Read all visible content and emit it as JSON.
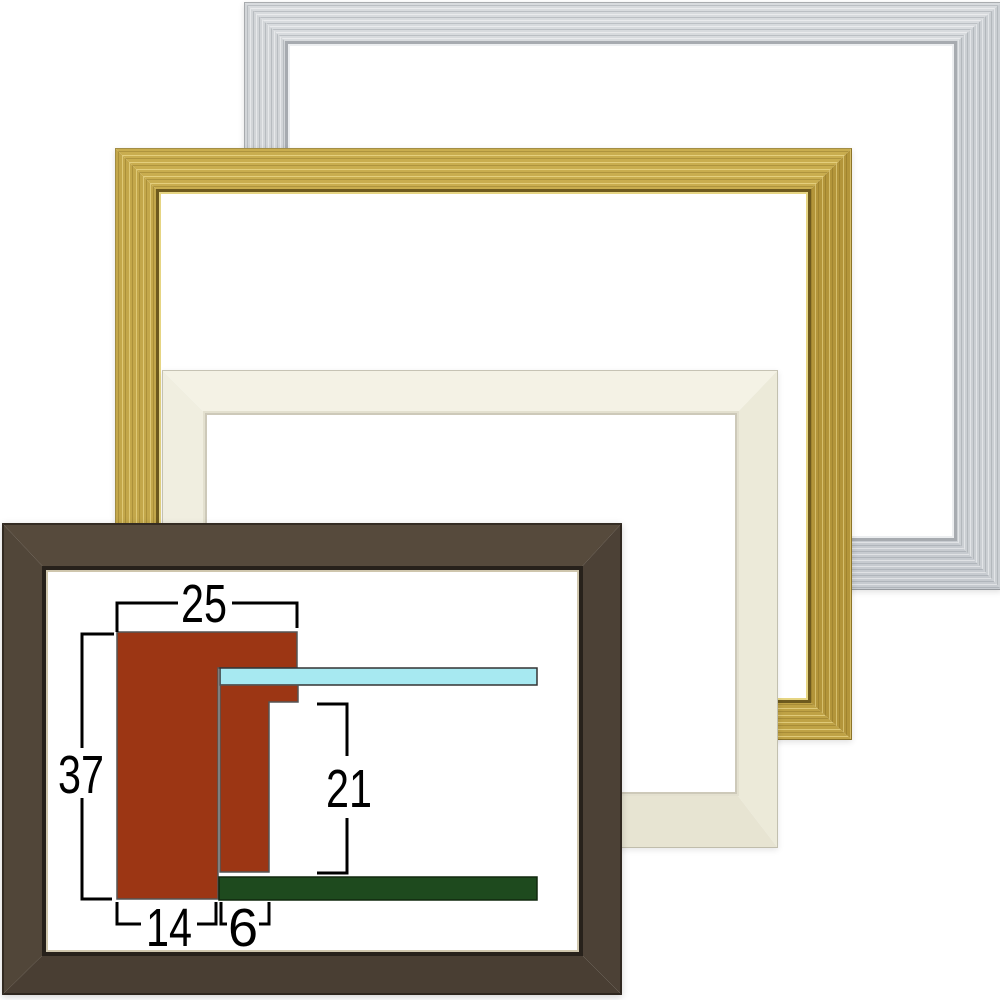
{
  "frames": {
    "silver": {
      "label": "silver-frame",
      "color": "#cfd3d6"
    },
    "gold": {
      "label": "gold-frame",
      "color": "#c4a94e"
    },
    "cream": {
      "label": "cream-white-frame",
      "color": "#f3f1e4"
    },
    "brown": {
      "label": "dark-brown-frame",
      "color": "#51453a"
    }
  },
  "diagram": {
    "type": "frame-cross-section",
    "dims": {
      "top_width": "25",
      "left_height": "37",
      "inner_height": "21",
      "bottom_face_width": "14",
      "spacer_width": "6"
    },
    "colors": {
      "molding": "#9c3614",
      "glass": "#a7e9f1",
      "backboard": "#1e4a1e",
      "dimension_line": "#000000",
      "shape_outline": "#555555"
    }
  }
}
